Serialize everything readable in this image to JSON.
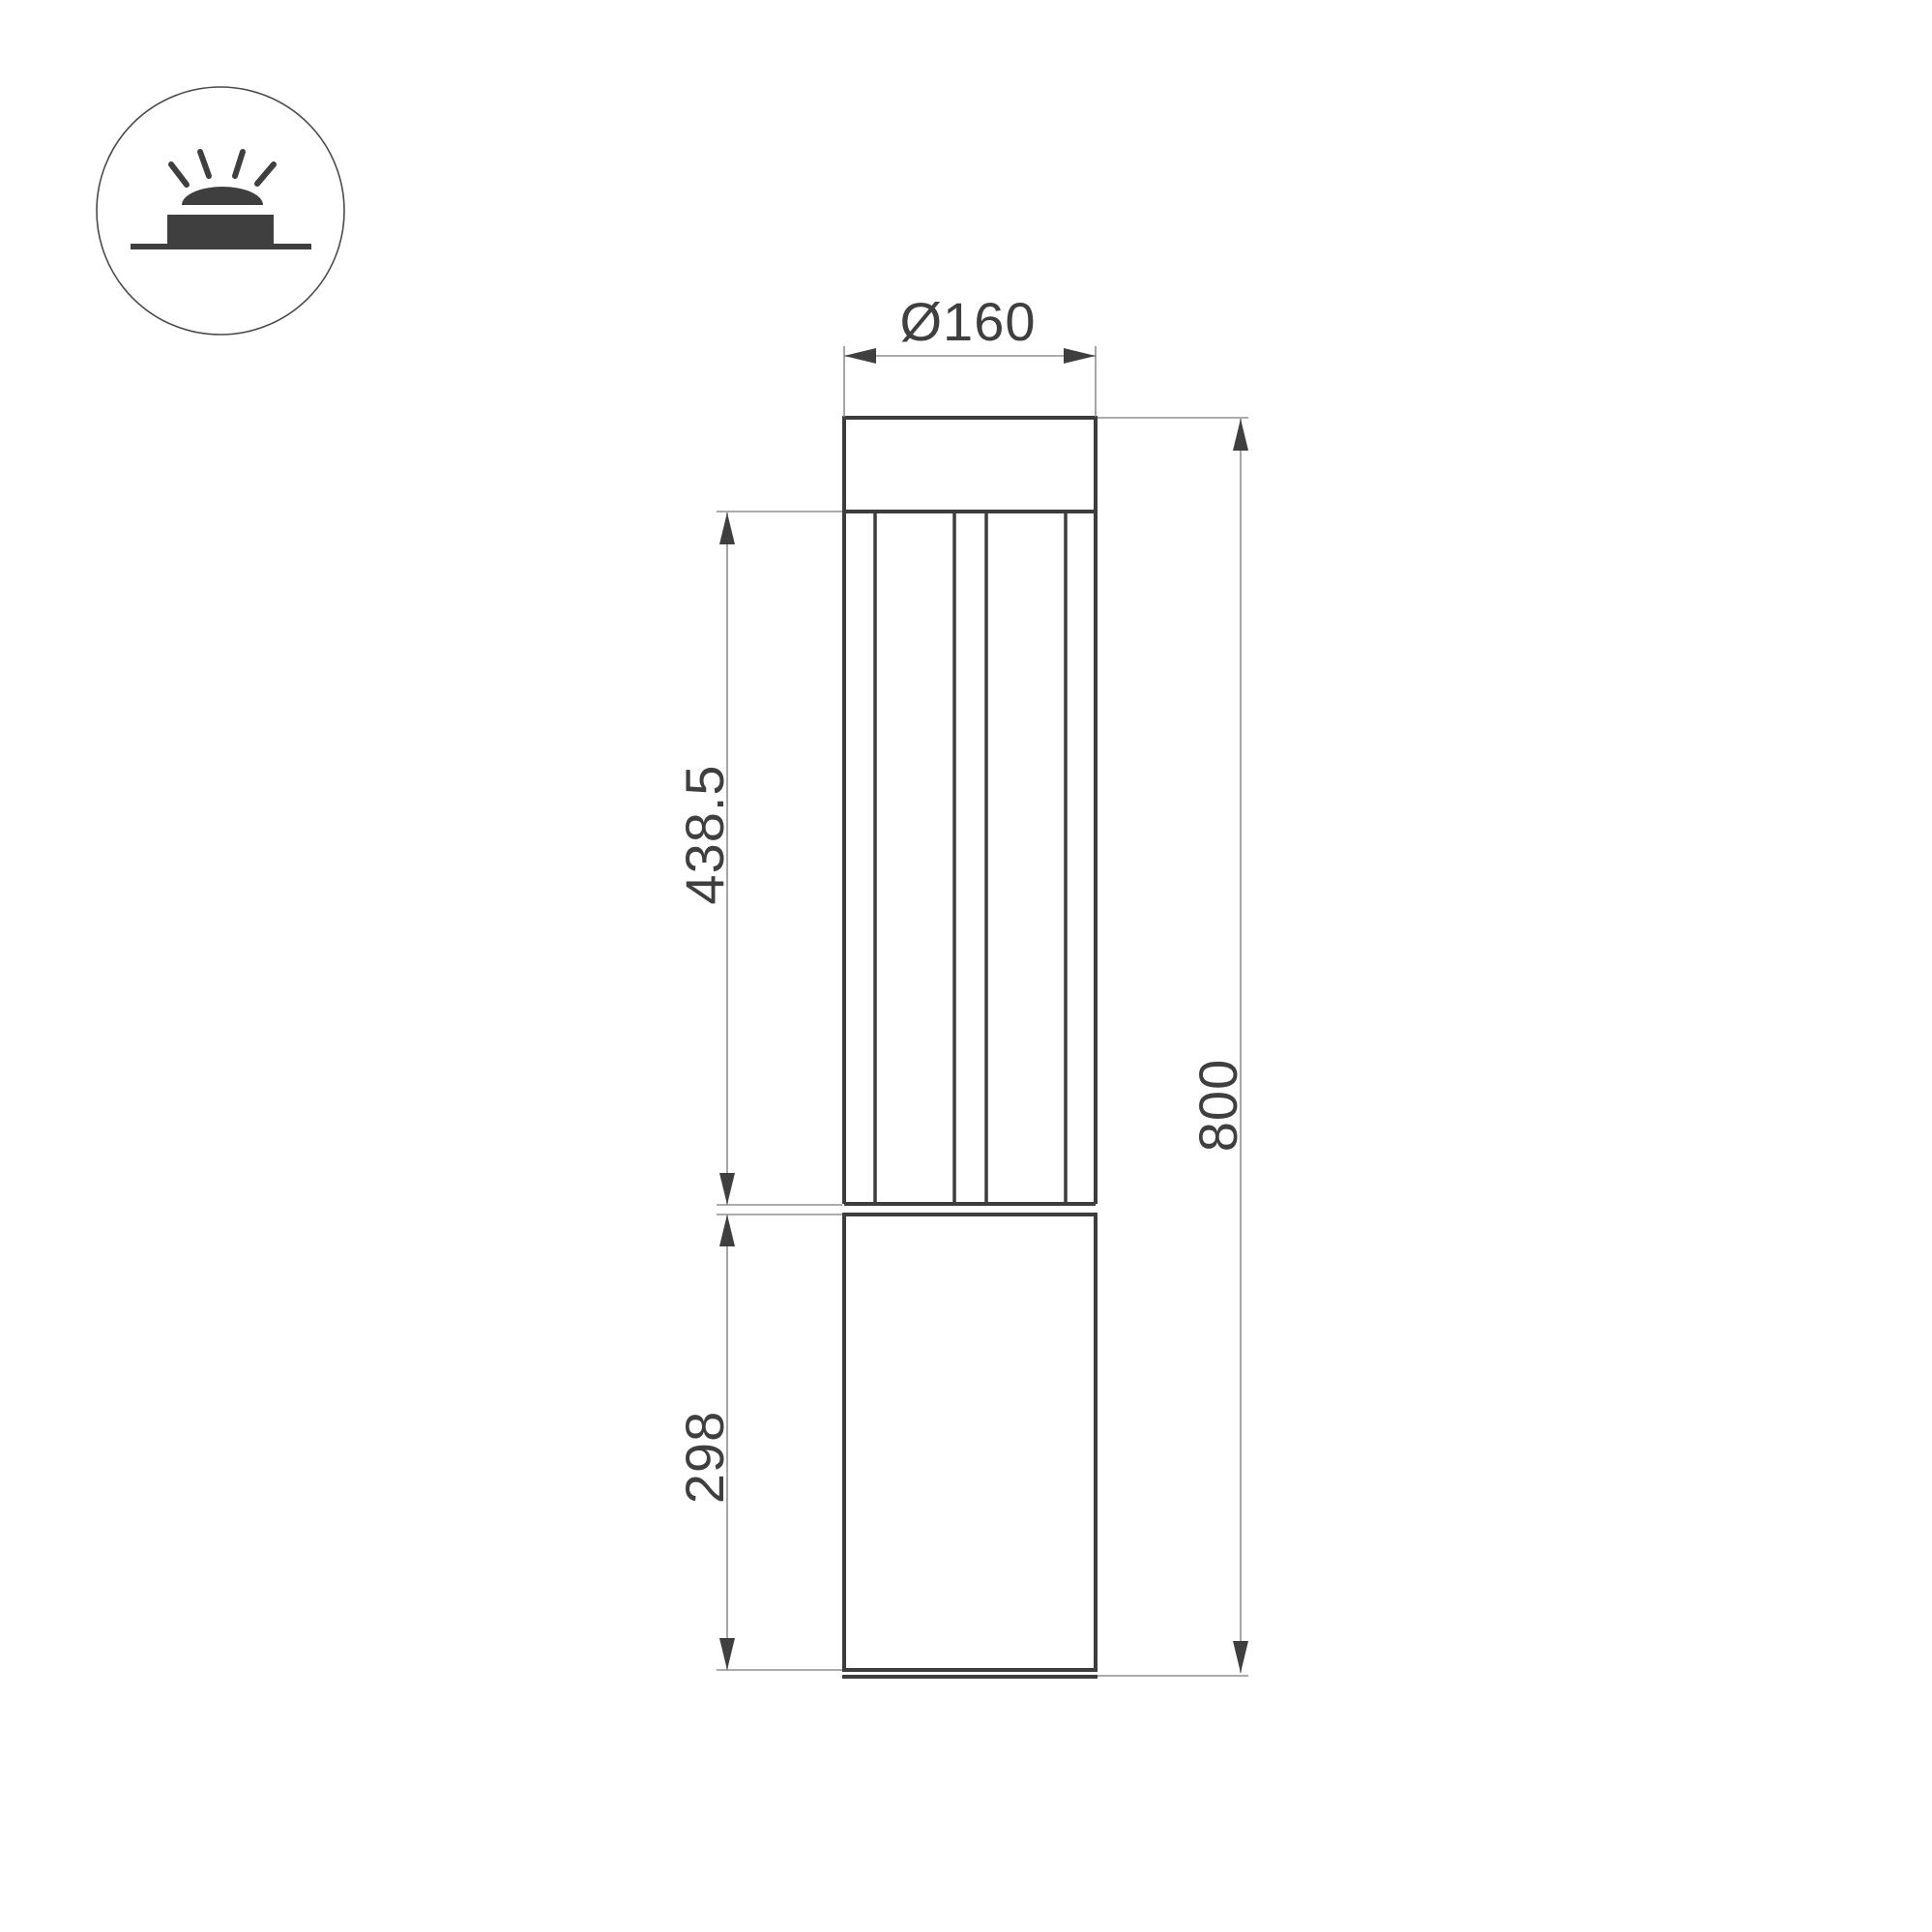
{
  "page": {
    "type": "technical-dimension-drawing",
    "background": "#ffffff"
  },
  "icon_badge": {
    "name": "ground-mounted-light-icon",
    "description": "circled pictogram of a bollard/ground luminaire: dome light over a base block on a ground line with four light rays",
    "ray_count": 4,
    "color": "#3f3f3f",
    "circle_stroke": "#4a4a4a"
  },
  "drawing": {
    "subject": "cylindrical bollard luminaire, front elevation with louvered lamp section and solid base",
    "dimensions": {
      "diameter": {
        "label": "Ø160",
        "orientation": "horizontal",
        "position": "top"
      },
      "lamp_section_height": {
        "label": "438.5",
        "orientation": "vertical",
        "position": "left-upper"
      },
      "base_section_height": {
        "label": "298",
        "orientation": "vertical",
        "position": "left-lower"
      },
      "overall_height": {
        "label": "800",
        "orientation": "vertical",
        "position": "right"
      }
    },
    "colors": {
      "outline": "#3d3d3d",
      "dimension_lines": "#8f8f8f",
      "arrows_and_text": "#3f3f3f"
    }
  }
}
